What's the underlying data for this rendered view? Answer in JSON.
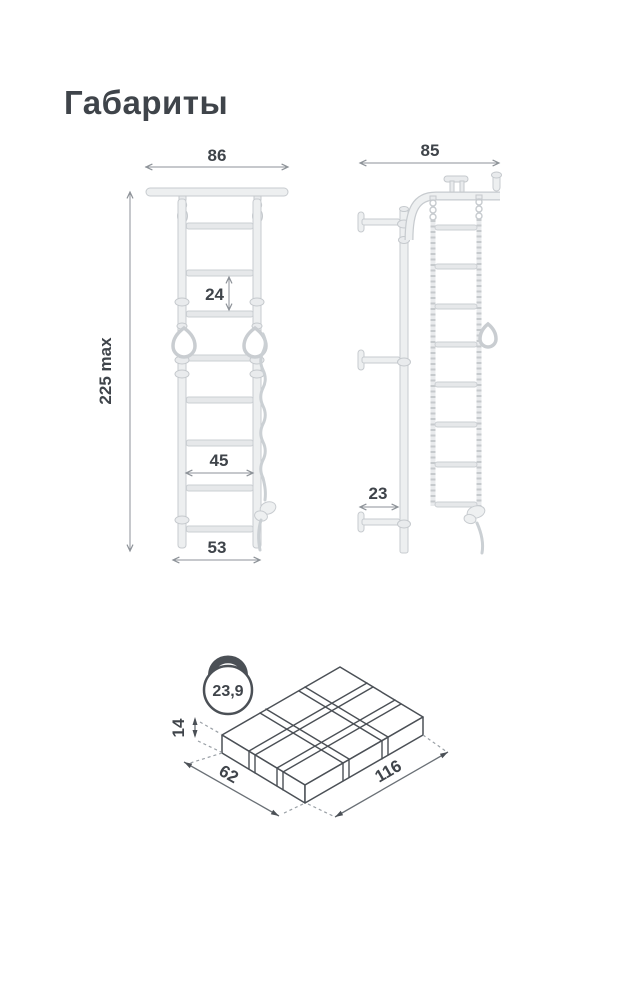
{
  "title": "Габариты",
  "colors": {
    "text": "#3f444a",
    "dimension_line": "#8d9298",
    "drawing_outline": "#c7cbcf",
    "drawing_fill": "#edeff0",
    "package_outline": "#4b5056",
    "background": "#ffffff"
  },
  "front_view": {
    "overall_width": "86",
    "overall_height": "225 max",
    "rung_spacing": "24",
    "inner_width": "45",
    "base_width": "53"
  },
  "side_view": {
    "overall_depth": "85",
    "wall_bracket_depth": "23"
  },
  "package": {
    "weight_icon": "kettlebell-icon",
    "weight_kg": "23,9",
    "height": "14",
    "depth": "62",
    "length": "116"
  }
}
